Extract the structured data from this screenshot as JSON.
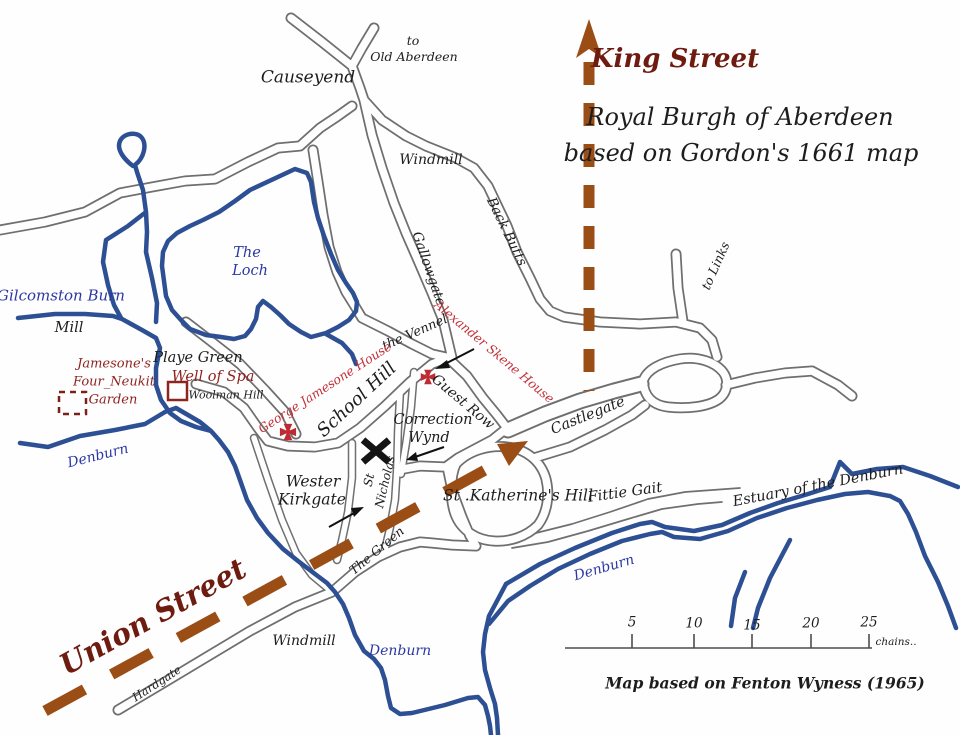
{
  "map": {
    "title_line1": "Royal Burgh of Aberdeen",
    "title_line2": "based on Gordon's 1661 map",
    "credit": "Map based on Fenton Wyness (1965)"
  },
  "modern_streets": {
    "king_street": "King Street",
    "union_street": "Union Street"
  },
  "labels": {
    "causeyend": "Causeyend",
    "to": "to",
    "old_aberdeen": "Old Aberdeen",
    "windmill_top": "Windmill",
    "back_butts": "Back Butts",
    "gallowgate": "Gallowgate",
    "to_links": "to Links",
    "the_vennel": "the Vennel",
    "school_hill": "School Hill",
    "guest_row": "Guest Row",
    "correction": "Correction",
    "wynd": "Wynd",
    "castlegate": "Castlegate",
    "st_nicholas_1": "St",
    "st_nicholas_2": "Nicholas",
    "wester": "Wester",
    "kirkgate": "Kirkgate",
    "the_green": "The Green",
    "st_katherines_hill": "St .Katherine's Hill",
    "fittie_gait": "Fittie Gait",
    "estuary": "Estuary of the Denburn",
    "the_loch_1": "The",
    "the_loch_2": "Loch",
    "gilcomston_burn": "Gilcomston Burn",
    "mill": "Mill",
    "denburn_left": "Denburn",
    "denburn_bottom": "Denburn",
    "denburn_estuary": "Denburn",
    "playe_green": "Playe Green",
    "well_of_spa": "Well of Spa",
    "woolman_hill": "Woolman Hill",
    "jamesones_1": "Jamesone's",
    "jamesones_2": "Four_Neukit",
    "jamesones_3": "Garden",
    "george_jamesone_house": "George Jamesone House",
    "alexander_skene_house": "Alexander Skene House",
    "hardgate": "Hardgate",
    "windmill_bottom": "Windmill"
  },
  "scale_bar": {
    "ticks": [
      "5",
      "10",
      "15",
      "20",
      "25"
    ],
    "unit_label": "chains.."
  },
  "colors": {
    "water": "#2d4f93",
    "road": "#6f6f6f",
    "modern_street": "#9a4d15",
    "modern_street_label": "#6e1b10",
    "historic_site": "#c2303a",
    "historic_site_dark": "#8e2420",
    "water_label": "#2b38a3",
    "text": "#1d1d1d"
  }
}
